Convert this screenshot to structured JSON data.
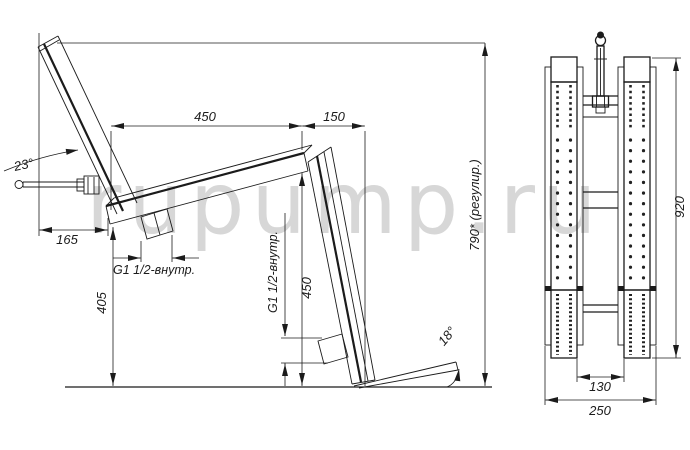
{
  "drawing": {
    "description": "Technical drawing of adjustable bench frame, side view and front view",
    "watermark": "rupump.ru"
  },
  "side_view": {
    "dims": {
      "seat_length": "450",
      "rear_overhang": "150",
      "backrest_angle": "23°",
      "front_offset": "165",
      "seat_height": "405",
      "rear_leg_height": "450",
      "overall_height": "790* (регулир.)",
      "foot_angle": "18°",
      "seat_fitting": "G1 1/2-внутр.",
      "leg_fitting": "G1 1/2-внутр."
    }
  },
  "front_view": {
    "dims": {
      "height": "920",
      "inner_width": "130",
      "overall_width": "250"
    }
  },
  "colors": {
    "line": "#1b1b1b",
    "watermark": "#d7d7d7",
    "background": "#ffffff"
  }
}
